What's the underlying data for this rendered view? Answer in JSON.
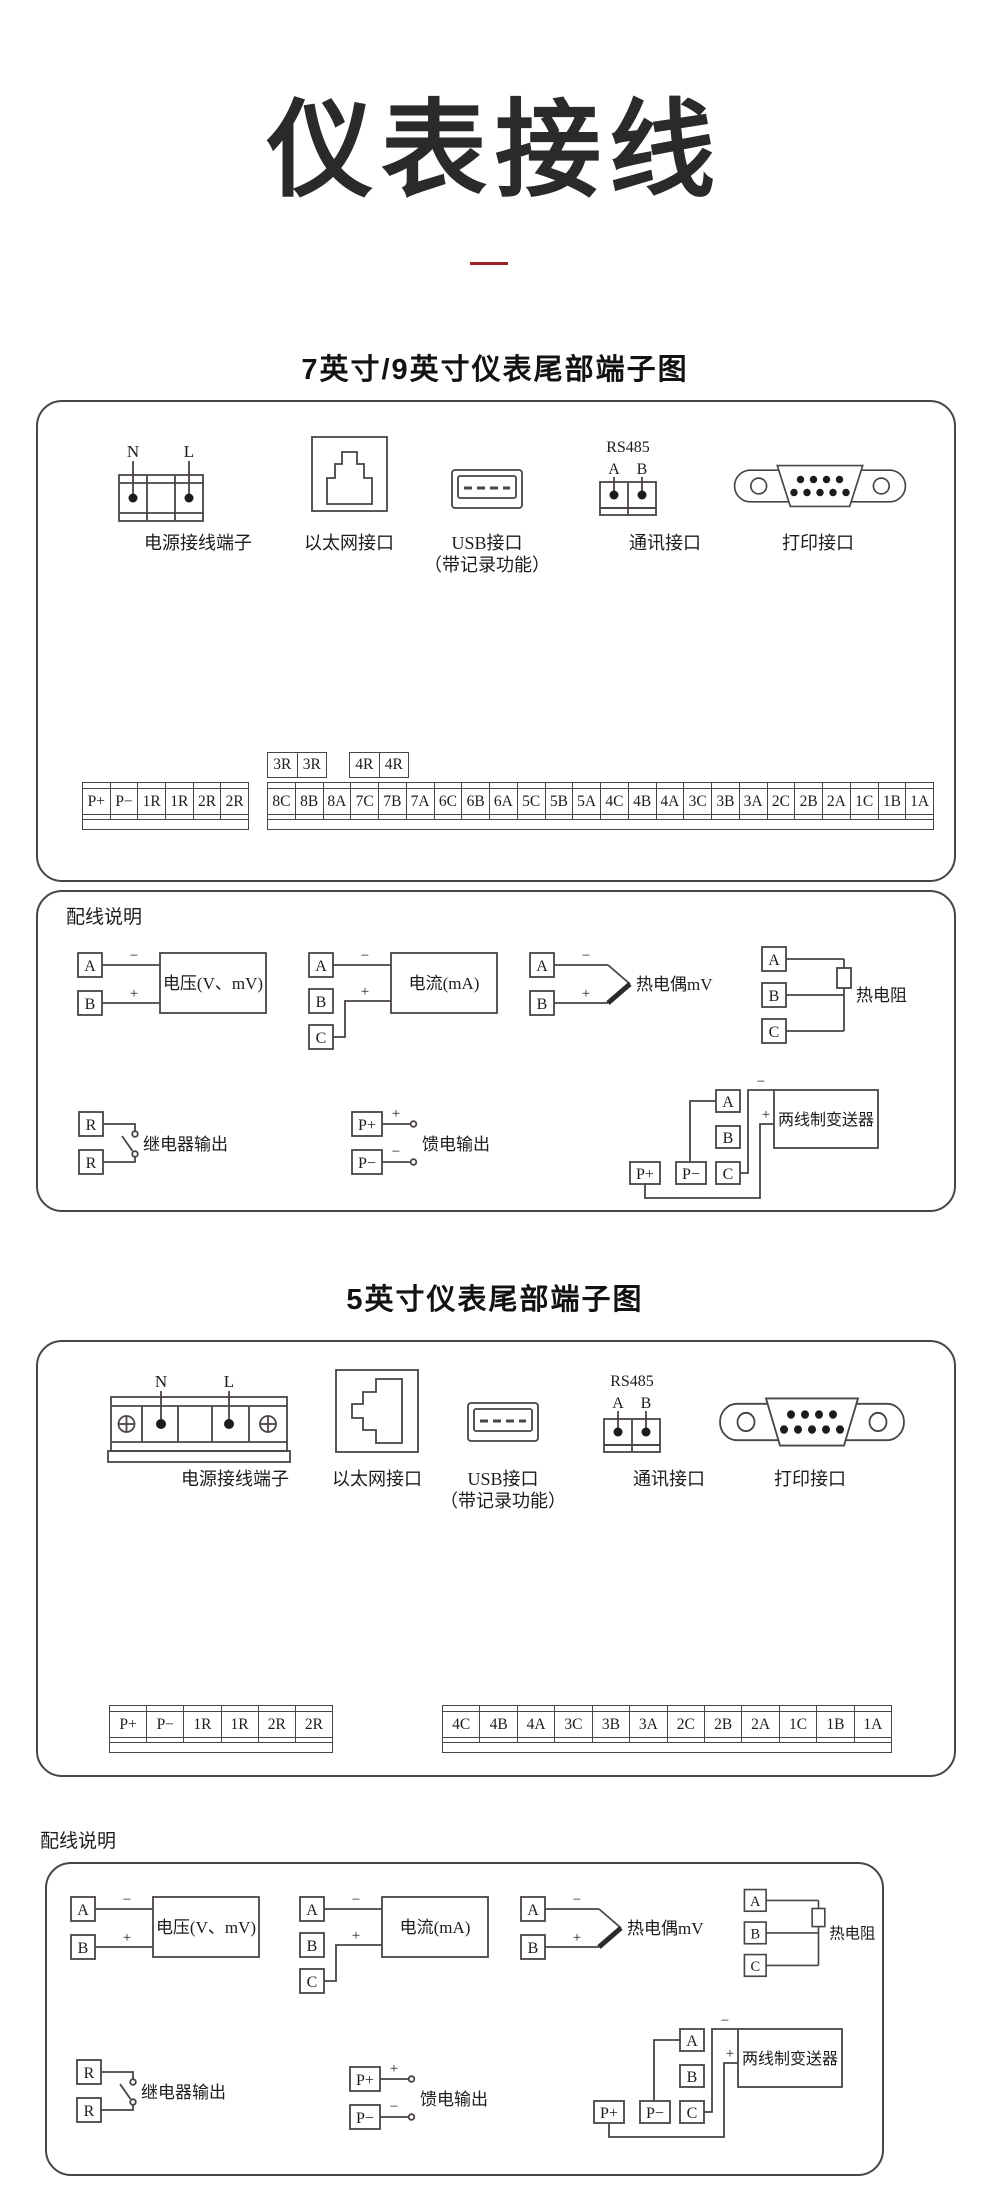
{
  "page": {
    "title": "仪表接线",
    "accent_color": "#9a2422",
    "line_color": "#4a4443"
  },
  "section_7_9": {
    "title": "7英寸/9英寸仪表尾部端子图",
    "power": {
      "n": "N",
      "l": "L",
      "label": "电源接线端子"
    },
    "ethernet": {
      "label": "以太网接口"
    },
    "usb": {
      "label": "USB接口",
      "sublabel": "（带记录功能）"
    },
    "comm": {
      "bus": "RS485",
      "a": "A",
      "b": "B",
      "label": "通讯接口"
    },
    "printer": {
      "label": "打印接口"
    },
    "relay_pair_1": [
      "3R",
      "3R"
    ],
    "relay_pair_2": [
      "4R",
      "4R"
    ],
    "left_strip": [
      "P+",
      "P−",
      "1R",
      "1R",
      "2R",
      "2R"
    ],
    "right_strip": [
      "8C",
      "8B",
      "8A",
      "7C",
      "7B",
      "7A",
      "6C",
      "6B",
      "6A",
      "5C",
      "5B",
      "5A",
      "4C",
      "4B",
      "4A",
      "3C",
      "3B",
      "3A",
      "2C",
      "2B",
      "2A",
      "1C",
      "1B",
      "1A"
    ]
  },
  "section_5": {
    "title": "5英寸仪表尾部端子图",
    "power": {
      "n": "N",
      "l": "L",
      "label": "电源接线端子"
    },
    "ethernet": {
      "label": "以太网接口"
    },
    "usb": {
      "label": "USB接口",
      "sublabel": "（带记录功能）"
    },
    "comm": {
      "bus": "RS485",
      "a": "A",
      "b": "B",
      "label": "通讯接口"
    },
    "printer": {
      "label": "打印接口"
    },
    "left_strip": [
      "P+",
      "P−",
      "1R",
      "1R",
      "2R",
      "2R"
    ],
    "right_strip": [
      "4C",
      "4B",
      "4A",
      "3C",
      "3B",
      "3A",
      "2C",
      "2B",
      "2A",
      "1C",
      "1B",
      "1A"
    ]
  },
  "wiring": {
    "heading": "配线说明",
    "voltage": {
      "a": "A",
      "b": "B",
      "minus": "−",
      "plus": "+",
      "label": "电压(V、mV)"
    },
    "current": {
      "a": "A",
      "b": "B",
      "c": "C",
      "minus": "−",
      "plus": "+",
      "label": "电流(mA)"
    },
    "thermocouple": {
      "a": "A",
      "b": "B",
      "minus": "−",
      "plus": "+",
      "label": "热电偶mV"
    },
    "rtd": {
      "a": "A",
      "b": "B",
      "c": "C",
      "label": "热电阻"
    },
    "relay": {
      "r1": "R",
      "r2": "R",
      "label": "继电器输出"
    },
    "feed": {
      "p_plus": "P+",
      "p_minus": "P−",
      "plus": "+",
      "minus": "−",
      "label": "馈电输出"
    },
    "transmitter": {
      "a": "A",
      "b": "B",
      "c": "C",
      "p_plus": "P+",
      "p_minus": "P−",
      "plus": "+",
      "minus": "−",
      "label": "两线制变送器"
    }
  }
}
